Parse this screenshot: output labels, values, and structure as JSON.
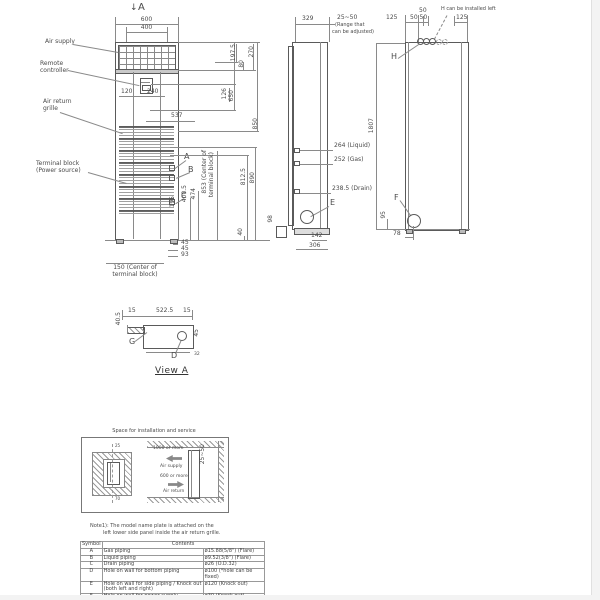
{
  "front_view": {
    "section_arrow": "↓",
    "section_label": "A",
    "label_air_supply": "Air supply",
    "label_remote_line1": "Remote",
    "label_remote_line2": "controller",
    "label_return_line1": "Air return",
    "label_return_line2": "grille",
    "label_terminal_line1": "Terminal block",
    "label_terminal_line2": "(Power source)",
    "callout_a": "A",
    "callout_b": "B",
    "callout_c": "C",
    "dim_600": "600",
    "dim_400": "400",
    "dim_120": "120",
    "dim_240": "240",
    "dim_537": "537",
    "dim_197_5": "197.5",
    "dim_80": "80",
    "dim_270": "270",
    "dim_126": "126",
    "dim_650": "650",
    "dim_850": "850",
    "dim_812_5": "812.5",
    "dim_890": "890",
    "dim_40": "40",
    "dim_195": "195",
    "dim_400_5": "400.5",
    "dim_474": "474",
    "dim_853_line1": "853 (Center of",
    "dim_853_line2": "terminal block)",
    "dim_45a": "45",
    "dim_45b": "45",
    "dim_93": "93",
    "dim_150_line1": "150 (Center of",
    "dim_150_line2": "terminal block)",
    "dim_98": "98"
  },
  "side_view": {
    "dim_329": "329",
    "dim_25_50": "25~50",
    "range_note_line1": "(Range that",
    "range_note_line2": "can be adjusted)",
    "dim_liquid": "264 (Liquid)",
    "dim_gas": "252 (Gas)",
    "dim_drain": "238.5 (Drain)",
    "callout_e": "E",
    "dim_142": "142",
    "dim_306": "306"
  },
  "rear_view": {
    "note_h": "H can be installed left",
    "dim_125_left": "125",
    "dim_50_top": "50",
    "dim_50_50": "50 50",
    "dim_125_right": "125",
    "callout_h": "H",
    "dim_1807": "1807",
    "callout_f": "F",
    "dim_95": "95",
    "dim_78": "78"
  },
  "view_a": {
    "title": "View A",
    "dim_15_left": "15",
    "dim_522_5": "522.5",
    "dim_15_right": "15",
    "dim_40_5": "40.5",
    "dim_45": "45",
    "dim_32": "32",
    "callout_g": "G",
    "callout_d": "D"
  },
  "space": {
    "title": "Space for installation and service",
    "dim_top": "25",
    "dim_bottom": "70",
    "dim_gap": "25~50",
    "supply_dim": "1000 or more",
    "supply_label": "Air supply",
    "return_dim": "600 or more",
    "return_label": "Air return"
  },
  "note": {
    "line1": "Note1): The model name plate is attached on the",
    "line2": "left lower side panel inside the air return grille."
  },
  "sym_table": {
    "header_symbol": "Symbol",
    "header_contents": "Contents",
    "rows": [
      {
        "symbol": "A",
        "contents": "Gas piping",
        "spec": "ø15.88(5/8\") (Flare)"
      },
      {
        "symbol": "B",
        "contents": "Liquid piping",
        "spec": "ø9.52(3/8\") (Flare)"
      },
      {
        "symbol": "C",
        "contents": "Drain piping",
        "spec": "ø26 (O.D.32)"
      },
      {
        "symbol": "D",
        "contents": "Hole on wall for bottom piping",
        "spec": "ø100 (*hole can be fixed)"
      },
      {
        "symbol": "E",
        "contents": "Hole on wall for side piping / Knock out (both left and right)",
        "spec": "ø120 (Knock out)"
      },
      {
        "symbol": "F",
        "contents": "Hole on wall for power supply",
        "spec": "ø30 (Knock out)"
      },
      {
        "symbol": "G",
        "contents": "Metal fittings to fix the unit",
        "spec": "M10 (2 pieces)"
      },
      {
        "symbol": "H",
        "contents": "Bolt pitch for wall fittings",
        "spec": "4-ø12 (Slot)"
      }
    ]
  }
}
